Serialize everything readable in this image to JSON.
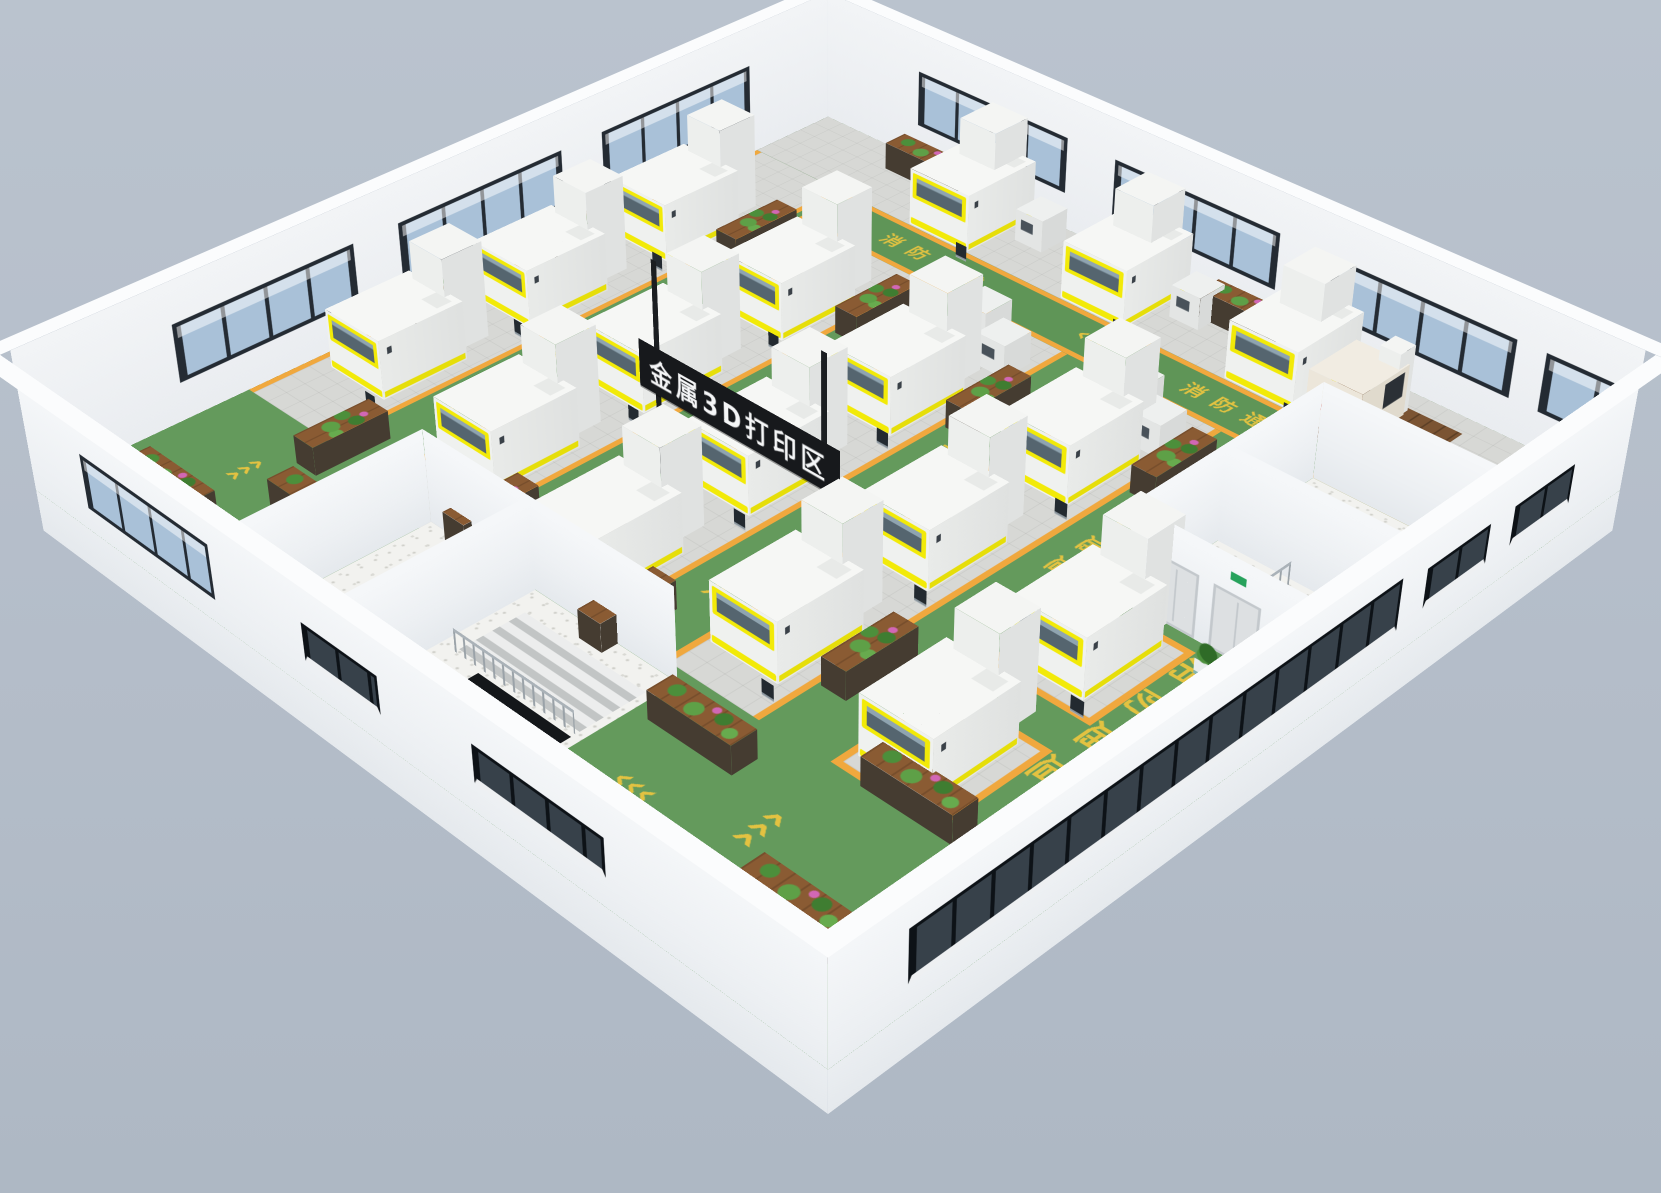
{
  "scene_title": "金属3D打印区",
  "sign": {
    "label": "金属3D打印区",
    "panel_color": "#17191c",
    "text_color": "#f5f6f7",
    "pole_color": "#1b1e21",
    "geometry": {
      "x": 395,
      "y": 659,
      "length": 280,
      "height": 55,
      "elevation": 95,
      "poles": [
        418,
        650
      ],
      "pole_height": 250
    }
  },
  "floor_markings": {
    "fire_lane_text": "消防通道",
    "arrow_glyph": "‹‹‹",
    "marking_color": "#e9c43f",
    "items": [
      {
        "k": "t",
        "x": 183,
        "y": 520,
        "r": 90,
        "s": 30
      },
      {
        "k": "a",
        "x": 183,
        "y": 330,
        "r": 90,
        "s": 40
      },
      {
        "k": "a",
        "x": 183,
        "y": 730,
        "r": 90,
        "s": 40
      },
      {
        "k": "t",
        "x": 389,
        "y": 560,
        "r": 90,
        "s": 30
      },
      {
        "k": "a",
        "x": 389,
        "y": 350,
        "r": 90,
        "s": 40
      },
      {
        "k": "t",
        "x": 603,
        "y": 500,
        "r": 90,
        "s": 30
      },
      {
        "k": "a",
        "x": 603,
        "y": 330,
        "r": 90,
        "s": 40
      },
      {
        "k": "a",
        "x": 603,
        "y": 745,
        "r": 90,
        "s": 40
      },
      {
        "k": "t",
        "x": 813,
        "y": 430,
        "r": 90,
        "s": 30
      },
      {
        "k": "a",
        "x": 813,
        "y": 280,
        "r": 90,
        "s": 40
      },
      {
        "k": "t",
        "x": 330,
        "y": 158,
        "r": 0,
        "s": 26
      },
      {
        "k": "a",
        "x": 560,
        "y": 158,
        "r": 0,
        "s": 34
      },
      {
        "k": "t",
        "x": 770,
        "y": 158,
        "r": 0,
        "s": 26
      },
      {
        "k": "t",
        "x": 1010,
        "y": 640,
        "r": 90,
        "s": 42
      },
      {
        "k": "a",
        "x": 990,
        "y": 420,
        "r": 90,
        "s": 48
      },
      {
        "k": "a",
        "x": 880,
        "y": 960,
        "r": 90,
        "s": 48
      },
      {
        "k": "a",
        "x": 120,
        "y": 950,
        "r": 90,
        "s": 38
      },
      {
        "k": "a",
        "x": 760,
        "y": 1000,
        "r": 0,
        "s": 40
      }
    ]
  },
  "palette": {
    "background": "#b4bdc9",
    "lane_green": "#649a5c",
    "lane_border_orange": "#f0a83e",
    "tile_gray": "#d7d8d5",
    "machine_accent_yellow": "#f2ea08",
    "machine_window_blue": "#55656f",
    "wall_white": "#eef1f4",
    "window_glass_light": "#a9c1d8",
    "window_glass_dark": "#37414a",
    "wood_brown": "#8a5b33"
  },
  "zones": {
    "walkway_ne": [
      0,
      0,
      1120,
      120
    ],
    "top_lane": [
      150,
      120,
      970,
      80
    ],
    "machine_strips": [
      [
        0,
        120,
        142,
        740
      ],
      [
        225,
        200,
        127,
        690
      ],
      [
        435,
        200,
        127,
        660
      ],
      [
        645,
        200,
        127,
        660
      ]
    ],
    "machine_pads": [
      [
        858,
        505,
        130,
        150
      ],
      [
        858,
        705,
        130,
        150
      ]
    ],
    "terrazzo_east": [
      890,
      200,
      230,
      290
    ],
    "terrazzo_south": [
      322,
      875,
      358,
      245
    ]
  },
  "machines": {
    "printer_count": 17,
    "printer_positions": [
      [
        250,
        6
      ],
      [
        480,
        6
      ],
      [
        710,
        6
      ],
      [
        26,
        260
      ],
      [
        26,
        460
      ],
      [
        26,
        660
      ],
      [
        237,
        285
      ],
      [
        237,
        485
      ],
      [
        237,
        685
      ],
      [
        447,
        335
      ],
      [
        447,
        535
      ],
      [
        447,
        735
      ],
      [
        657,
        300
      ],
      [
        657,
        500
      ],
      [
        657,
        700
      ],
      [
        870,
        520
      ],
      [
        870,
        720
      ]
    ],
    "small_unit_count": 8,
    "small_unit_positions": [
      [
        448,
        208
      ],
      [
        506,
        242
      ],
      [
        452,
        282
      ],
      [
        660,
        208
      ],
      [
        718,
        242
      ],
      [
        664,
        282
      ],
      [
        360,
        18
      ],
      [
        590,
        22
      ]
    ],
    "cmm": {
      "x": 818,
      "y": 42,
      "mat": [
        800,
        28,
        150,
        115
      ]
    }
  },
  "plant_shelves": [
    [
      146,
      228,
      32,
      95
    ],
    [
      146,
      812,
      32,
      95
    ],
    [
      356,
      250,
      32,
      95
    ],
    [
      356,
      790,
      32,
      95
    ],
    [
      566,
      300,
      32,
      95
    ],
    [
      566,
      800,
      32,
      95
    ],
    [
      776,
      255,
      32,
      95
    ],
    [
      776,
      690,
      32,
      95
    ],
    [
      12,
      385,
      32,
      70
    ],
    [
      12,
      585,
      32,
      70
    ],
    [
      140,
      12,
      100,
      32
    ],
    [
      612,
      10,
      100,
      32
    ],
    [
      700,
      898,
      110,
      32
    ],
    [
      900,
      828,
      110,
      32
    ],
    [
      60,
      1020,
      110,
      32
    ],
    [
      190,
      940,
      110,
      32
    ],
    [
      930,
      1005,
      110,
      32
    ]
  ],
  "potted_plants": [
    [
      905,
      500
    ],
    [
      1005,
      500
    ]
  ],
  "walls": {
    "nw": {
      "height": 165,
      "windows": [
        [
          180,
          410
        ],
        [
          470,
          700
        ],
        [
          760,
          990
        ]
      ]
    },
    "ne": {
      "height": 165,
      "windows": [
        [
          150,
          380
        ],
        [
          450,
          680
        ],
        [
          750,
          980
        ],
        [
          1015,
          1105
        ]
      ]
    },
    "se": {
      "height": 150,
      "ribbon": [
        90,
        740
      ],
      "windows_dark": [
        [
          780,
          880
        ],
        [
          920,
          1020
        ]
      ]
    },
    "sw": {
      "height": 150,
      "windows_light": [
        [
          100,
          310
        ]
      ],
      "windows_dark": [
        [
          450,
          560
        ],
        [
          690,
          860
        ]
      ]
    }
  },
  "rooms": {
    "east": {
      "walls": [
        {
          "d": "x",
          "x": 890,
          "y": 490,
          "len": 290,
          "h": 115
        },
        {
          "d": "y",
          "x": 890,
          "y": 200,
          "len": 230,
          "h": 115
        },
        {
          "d": "y",
          "x": 890,
          "y": 352,
          "len": 230,
          "h": 115
        },
        {
          "d": "y",
          "x": 890,
          "y": 490,
          "len": 230,
          "h": 115,
          "doors": true
        }
      ],
      "stairwell": [
        985,
        362,
        125,
        115
      ],
      "railing": {
        "d": "x",
        "x": 985,
        "y": 477,
        "len": 115,
        "h": 30
      }
    },
    "south": {
      "walls": [
        {
          "d": "y",
          "x": 322,
          "y": 875,
          "len": 358,
          "h": 110
        },
        {
          "d": "x",
          "x": 322,
          "y": 1120,
          "len": 245,
          "h": 110
        },
        {
          "d": "x",
          "x": 480,
          "y": 1120,
          "len": 245,
          "h": 110
        }
      ],
      "stairs": [
        500,
        905,
        170,
        80
      ],
      "railing": {
        "d": "y",
        "x": 500,
        "y": 990,
        "len": 170,
        "h": 28
      },
      "opening": [
        540,
        995,
        130,
        100
      ]
    }
  }
}
